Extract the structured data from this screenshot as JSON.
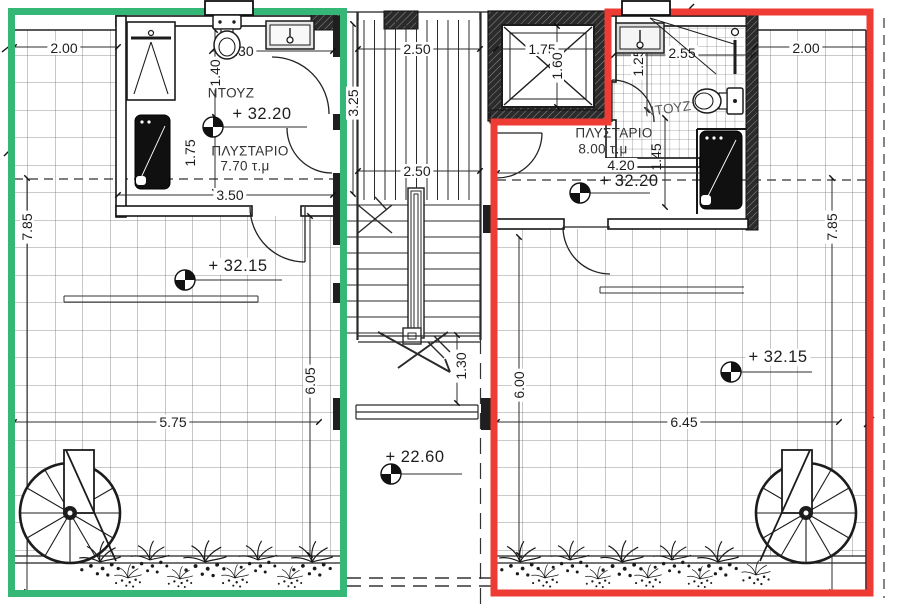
{
  "colors": {
    "left_unit_outline": "#35b877",
    "right_unit_outline": "#ee3b33",
    "line": "#1c1c1c",
    "wall": "#242424"
  },
  "left": {
    "room_name": "ΠΛΥΣΤΑΡΙΟ",
    "room_area": "7.70 τ.μ",
    "shower": "ΝΤΟΥΖ",
    "level_room": "+ 32.20",
    "level_terrace": "+ 32.15",
    "dim_width_top": "2.00",
    "dim_wc": "2.30",
    "dim_shower_h": "1.40",
    "dim_mach_h": "1.75",
    "dim_room_w": "3.50",
    "dim_terrace_h": "7.85",
    "dim_terrace_inner_h": "6.05",
    "dim_terrace_w": "5.75"
  },
  "center": {
    "dim_stair_top": "2.50",
    "dim_stair_mid": "2.50",
    "dim_stair_len": "3.25",
    "dim_landing": "1.30",
    "level_landing": "+ 22.60",
    "elevator_w": "1.75",
    "elevator_d": "1.60"
  },
  "right": {
    "room_name": "ΠΛΥΣΤΑΡΙΟ",
    "room_area": "8.00 τ.μ",
    "shower": "ΝΤΟΥΖ",
    "level_room": "+ 32.20",
    "level_terrace": "+ 32.15",
    "dim_bath_w": "2.55",
    "dim_bath_h": "1.25",
    "dim_mach_h": "1.45",
    "dim_room_w": "4.20",
    "dim_width_top": "2.00",
    "dim_terrace_h": "7.85",
    "dim_terrace_inner_h": "6.00",
    "dim_terrace_w": "6.45"
  }
}
